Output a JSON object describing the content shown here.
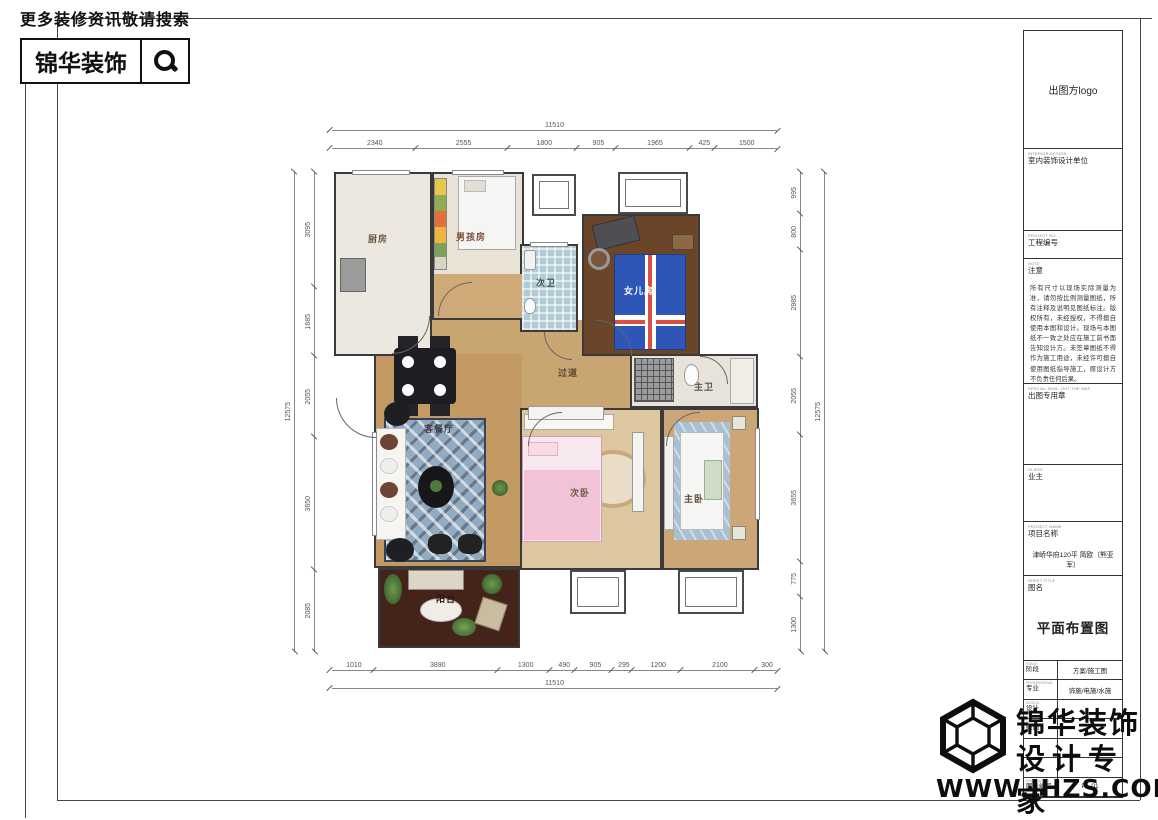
{
  "header": {
    "slogan": "更多装修资讯敬请搜索",
    "brand": "锦华装饰"
  },
  "plan": {
    "rooms": {
      "kitchen": "厨房",
      "boys_room": "男孩房",
      "bath2": "次卫",
      "girls_room": "女儿房",
      "hallway": "过道",
      "master_bath": "主卫",
      "living_dining": "客餐厅",
      "bedroom2": "次卧",
      "master_bedroom": "主卧",
      "balcony": "阳台"
    },
    "dims": {
      "top_total": "11510",
      "top": [
        "2340",
        "2555",
        "1800",
        "905",
        "1965",
        "425",
        "1500"
      ],
      "bottom": [
        "1010",
        "3890",
        "1300",
        "490",
        "905",
        "295",
        "1200",
        "2100",
        "300"
      ],
      "bottom_total": "11510",
      "left_total": "12575",
      "left": [
        "3095",
        "1685",
        "2055",
        "3650",
        "2085"
      ],
      "right": [
        "995",
        "800",
        "2985",
        "2055",
        "3655",
        "775",
        "1300"
      ],
      "right_total": "12575"
    }
  },
  "titleblock": {
    "logo_text": "出图方logo",
    "interior_design_en": "INTERIOR DESIGN",
    "interior_design": "室内装饰设计单位",
    "project_no_en": "PROJECT NO.",
    "project_no": "工程编号",
    "note_en": "NOTE",
    "note_label": "注意",
    "note_text": "所有尺寸以现场实际测量为准，请勿按比例测量图纸，所有注释及说明见图纸标注。版权所有，未经授权，不得擅自使用本图和设计。现场与本图纸不一致之处应在施工前书面告知设计方。未签章图纸不得作为施工用途，未经许可擅自使用图纸指导施工，原设计方不负责任何后果。",
    "seal_en": "SPECIAL SEAL, OUT THE MAP",
    "seal_label": "出图专用章",
    "client_en": "CLIENT",
    "client_label": "业主",
    "project_name_en": "PROJECT NAME",
    "project_name_label": "项目名称",
    "project_name_value": "津峤华府120平 简欧（熊亚军）",
    "sheet_title_en": "SHEET TITLE",
    "sheet_title_label": "图名",
    "sheet_title_value": "平面布置图",
    "rows": [
      {
        "en": "STAGE",
        "label": "阶段",
        "value": "方案/施工图"
      },
      {
        "en": "PROFESSIONAL",
        "label": "专业",
        "value": "饰施/电施/水施"
      },
      {
        "en": "DESIGN",
        "label": "设计",
        "value": ""
      },
      {
        "en": "DRAW",
        "label": "绘图",
        "value": ""
      },
      {
        "en": "",
        "label": "",
        "value": ""
      },
      {
        "en": "",
        "label": "",
        "value": ""
      },
      {
        "en": "DRAWING NO.",
        "label": "图纸编号",
        "value": "PL-01"
      }
    ]
  },
  "watermark": {
    "brand": "锦华装饰",
    "tagline": "设计专家",
    "url": "WWW.JHZS.COM"
  }
}
